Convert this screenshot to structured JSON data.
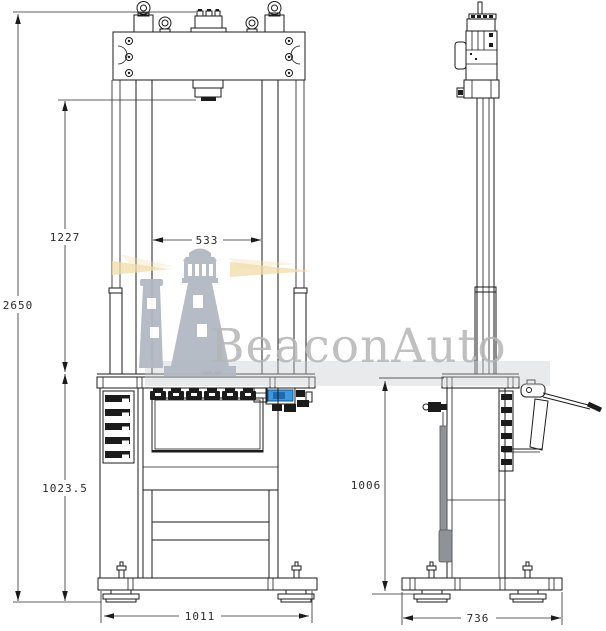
{
  "watermark": {
    "brand_text": "BeaconAuto"
  },
  "dimensions": {
    "front": {
      "overall_height": "2650",
      "opening_height": "1227",
      "column_clear_width": "533",
      "table_height": "1023.5",
      "base_width": "1011"
    },
    "side": {
      "table_height": "1006",
      "base_depth": "736"
    }
  },
  "colors": {
    "line": "#1b1b1b",
    "gauge_blue": "#3b9ae1",
    "gauge_blue_dark": "#1e6cb0",
    "watermark_gray": "#b2b9c3",
    "watermark_band": "#c6cacf",
    "watermark_text": "#b6b6b6",
    "beam_yellow": "#f1dcaa",
    "pedal_gray": "#8f9296"
  }
}
